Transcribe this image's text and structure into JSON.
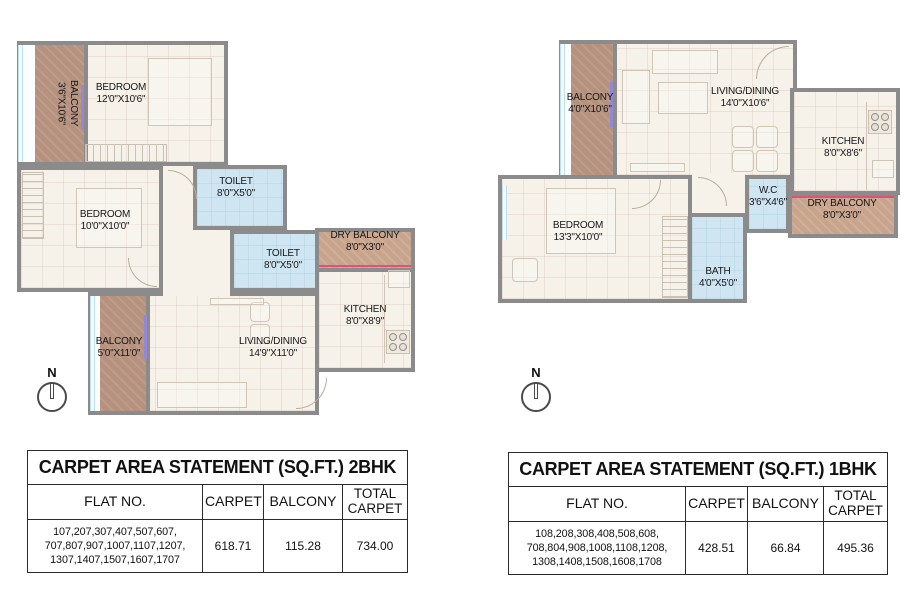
{
  "colors": {
    "wall": "#8b8b8b",
    "floor": "#f6f1e9",
    "balcony": "#b5917e",
    "dry_balcony": "#c8a48c",
    "wet": "#cfe6f2",
    "pink": "#e0517a",
    "purple": "#9288d4",
    "table_border": "#2b2b2b",
    "muted_value": "#9b9b9b",
    "text": "#111111"
  },
  "plans": {
    "left": {
      "compass_label": "N",
      "rooms": {
        "balcony_top": {
          "name": "BALCONY",
          "dims": "3'6\"X10'6\""
        },
        "bedroom_top": {
          "name": "BEDROOM",
          "dims": "12'0\"X10'6\""
        },
        "bedroom_mid": {
          "name": "BEDROOM",
          "dims": "10'0\"X10'0\""
        },
        "toilet_top": {
          "name": "TOILET",
          "dims": "8'0\"X5'0\""
        },
        "toilet_bottom": {
          "name": "TOILET",
          "dims": "8'0\"X5'0\""
        },
        "dry_balcony": {
          "name": "DRY BALCONY",
          "dims": "8'0\"X3'0\""
        },
        "kitchen": {
          "name": "KITCHEN",
          "dims": "8'0\"X8'9\""
        },
        "living": {
          "name": "LIVING/DINING",
          "dims": "14'9\"X11'0\""
        },
        "balcony_bottom": {
          "name": "BALCONY",
          "dims": "5'0\"X11'0\""
        }
      }
    },
    "right": {
      "compass_label": "N",
      "rooms": {
        "balcony": {
          "name": "BALCONY",
          "dims": "4'0\"X10'6\""
        },
        "living": {
          "name": "LIVING/DINING",
          "dims": "14'0\"X10'6\""
        },
        "kitchen": {
          "name": "KITCHEN",
          "dims": "8'0\"X8'6\""
        },
        "wc": {
          "name": "W.C",
          "dims": "3'6\"X4'6\""
        },
        "dry_balcony": {
          "name": "DRY BALCONY",
          "dims": "8'0\"X3'0\""
        },
        "bedroom": {
          "name": "BEDROOM",
          "dims": "13'3\"X10'0\""
        },
        "bath": {
          "name": "BATH",
          "dims": "4'0\"X5'0\""
        }
      }
    }
  },
  "tables": {
    "left": {
      "title": "CARPET AREA STATEMENT (SQ.FT.) 2BHK",
      "headers": {
        "flat": "FLAT NO.",
        "carpet": "CARPET",
        "balcony": "BALCONY",
        "total": "TOTAL CARPET"
      },
      "row": {
        "flat_lines": [
          "107,207,307,407,507,607,",
          "707,807,907,1007,1107,1207,",
          "1307,1407,1507,1607,1707"
        ],
        "carpet": "618.71",
        "balcony": "115.28",
        "total": "734.00"
      }
    },
    "right": {
      "title": "CARPET AREA STATEMENT (SQ.FT.) 1BHK",
      "headers": {
        "flat": "FLAT NO.",
        "carpet": "CARPET",
        "balcony": "BALCONY",
        "total": "TOTAL CARPET"
      },
      "row": {
        "flat_lines": [
          "108,208,308,408,508,608,",
          "708,804,908,1008,1108,1208,",
          "1308,1408,1508,1608,1708"
        ],
        "carpet": "428.51",
        "balcony": "66.84",
        "total": "495.36"
      }
    }
  }
}
